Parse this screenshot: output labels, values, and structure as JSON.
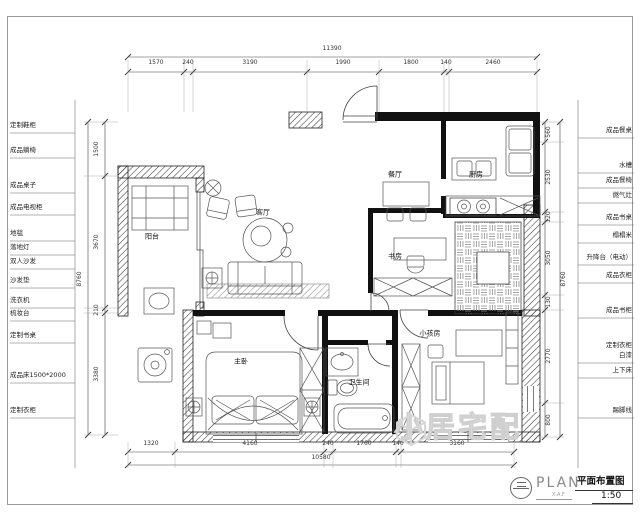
{
  "title_block": {
    "plan": "PLAN",
    "plan_sub": "X.A.F",
    "name": "平面布置图",
    "scale": "1:50"
  },
  "watermark": {
    "text": "小居宅配"
  },
  "rooms": {
    "balcony": "阳台",
    "living": "客厅",
    "dining": "餐厅",
    "kitchen": "厨房",
    "study": "书房",
    "master": "主卧",
    "bath": "卫生间",
    "kids": "小孩房"
  },
  "dims": {
    "top": {
      "overall": "11390",
      "segments": [
        "1570",
        "240",
        "3190",
        "1990",
        "1800",
        "140",
        "2460"
      ]
    },
    "bottom": {
      "overall": "10580",
      "segments": [
        "1320",
        "4160",
        "240",
        "1760",
        "140",
        "3160"
      ]
    },
    "left": {
      "overall": "8760",
      "segments": [
        "1500",
        "3670",
        "210",
        "3380"
      ]
    },
    "right": {
      "overall": "8760",
      "segments": [
        "560",
        "2530",
        "120",
        "3050",
        "130",
        "2770",
        "800"
      ]
    }
  },
  "labels_left": [
    "定制鞋柜",
    "成品躺椅",
    "成品桌子",
    "成品电视柜",
    "地毯",
    "落地灯",
    "双人沙发",
    "沙发垫",
    "洗衣机",
    "梳妆台",
    "定制书桌",
    "成品床1500*2000",
    "定制衣柜"
  ],
  "labels_right": [
    "成品餐桌",
    "水槽",
    "成品餐椅",
    "燃气灶",
    "成品书桌",
    "榻榻米",
    "升降台（电动）",
    "成品衣柜",
    "成品书柜",
    "定制衣柜",
    "白漆",
    "上下床",
    "踢脚线"
  ],
  "colors": {
    "wall": "#222222",
    "line": "#555555",
    "dim": "#333333",
    "watermark": "#d9d9d9"
  }
}
